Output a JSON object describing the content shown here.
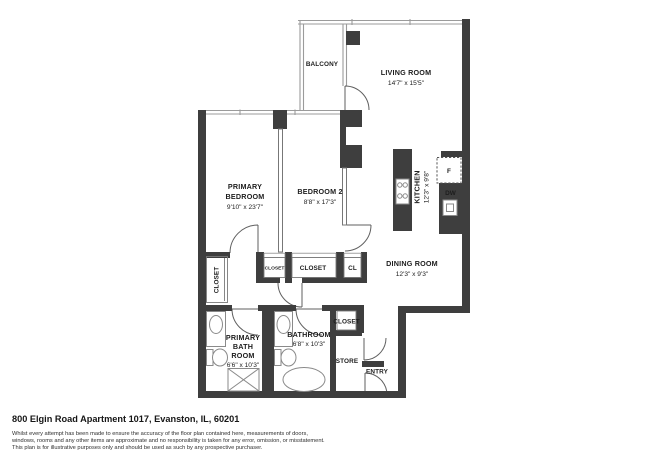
{
  "colors": {
    "wall": "#3e3e3e",
    "thin_line": "#9b9b9b",
    "text": "#1d1d1d"
  },
  "plan": {
    "balcony_label": "BALCONY",
    "living_room_label": "LIVING ROOM",
    "living_room_dims": "14'7\" x 15'5\"",
    "primary_bedroom_line1": "PRIMARY",
    "primary_bedroom_line2": "BEDROOM",
    "primary_bedroom_dims": "9'10\" x 23'7\"",
    "bedroom2_label": "BEDROOM 2",
    "bedroom2_dims": "8'8\" x 17'3\"",
    "kitchen_label": "KITCHEN",
    "kitchen_dims": "12'3\" x 9'8\"",
    "dining_room_label": "DINING ROOM",
    "dining_room_dims": "12'3\" x 9'3\"",
    "primary_bath_line1": "PRIMARY",
    "primary_bath_line2": "BATH",
    "primary_bath_line3": "ROOM",
    "primary_bath_dims": "6'6\" x 10'3\"",
    "bathroom_label": "BATHROOM",
    "bathroom_dims": "6'8\" x 10'3\"",
    "closet_tall_label": "CLOSET",
    "closet_small_label": "CLOSET",
    "closet_main_label": "CLOSET",
    "closet_cl_label": "CL",
    "closet_bath_label": "CLOSET",
    "store_label": "STORE",
    "entry_label": "ENTRY",
    "fridge_label": "F",
    "dishwasher_label": "DW"
  },
  "footer": {
    "address": "800 Elgin Road Apartment 1017, Evanston, IL, 60201",
    "disclaimer_line1": "Whilst every attempt has been made to ensure the accuracy of the floor plan contained here, measurements of doors,",
    "disclaimer_line2": "windows, rooms and any other items are approximate and no responsibility is taken for any error, omission, or misstatement.",
    "disclaimer_line3": "This plan is for illustrative purposes only and should be used as such by any prospective purchaser."
  }
}
